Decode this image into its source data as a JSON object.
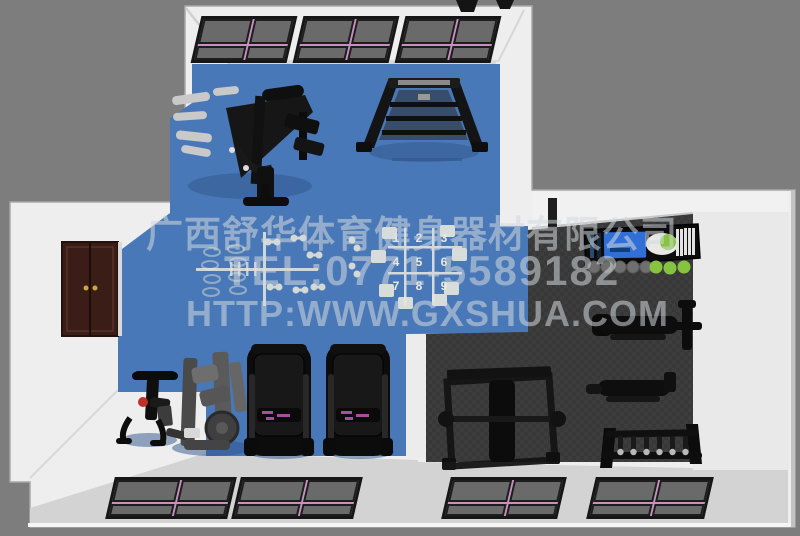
{
  "scene_type": "3d-gym-floor-plan-render",
  "watermark": {
    "company": "广西舒华体育健身器材有限公司",
    "tel": "TEL:0771-5589182",
    "url": "HTTP:WWW.GXSHUA.COM"
  },
  "grid": {
    "cells": [
      "1",
      "2",
      "3",
      "4",
      "5",
      "6",
      "7",
      "8",
      "9"
    ]
  },
  "colors": {
    "background": "#7d7d7d",
    "blue_floor": "#4878b7",
    "dark_floor": "#393939",
    "wall_white": "#eeeeee",
    "wall_shade": "#d3d3d3",
    "floor_light": "#e9e9e9",
    "window_frame": "#161616",
    "window_glass": "#6a6a6a",
    "window_trim_pink": "#c98fc0",
    "door_brown": "#3b1d18",
    "accent_blue": "#2f6fd6",
    "accent_green": "#86c440",
    "watermark_text": "rgba(212,216,222,0.55)"
  },
  "equipment": [
    "multi-station-gym",
    "a-frame-functional-trainer",
    "spin-bike",
    "cable-strength-machine",
    "treadmill-left",
    "treadmill-right",
    "power-rack-with-bench",
    "flat-bench-with-stand",
    "adjustable-bench",
    "barbell-rack",
    "dumbbell-storage-rack"
  ]
}
